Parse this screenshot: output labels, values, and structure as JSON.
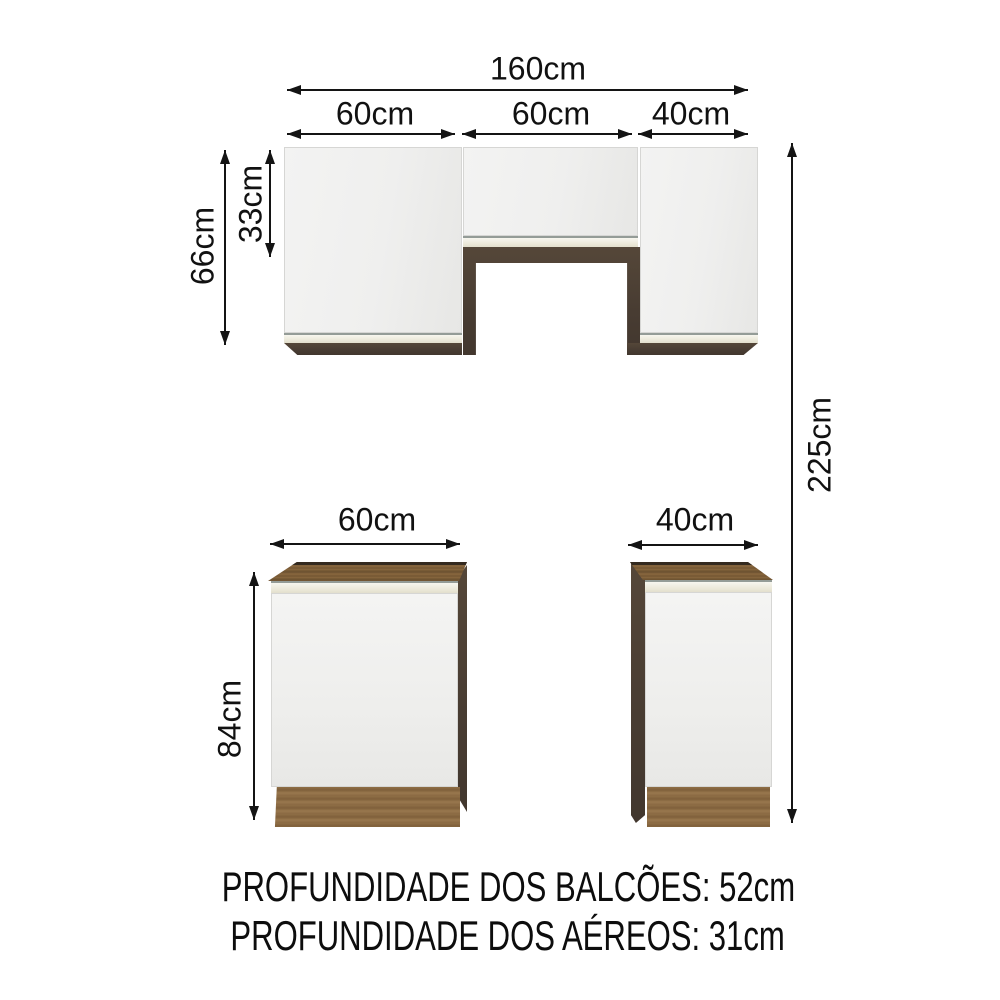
{
  "dimensions": {
    "total_width": "160cm",
    "upper_segments": {
      "left": "60cm",
      "middle": "60cm",
      "right": "40cm"
    },
    "upper_unit_height": "66cm",
    "upper_middle_door_height": "33cm",
    "total_height": "225cm",
    "base_left_width": "60cm",
    "base_right_width": "40cm",
    "base_height": "84cm"
  },
  "footer": {
    "line1": "PROFUNDIDADE DOS BALCÕES: 52cm",
    "line2": "PROFUNDIDADE DOS AÉREOS: 31cm"
  },
  "colors": {
    "door_white": "#efefee",
    "trim_cream": "#ebe8d9",
    "wood_dark": "#4a3e35",
    "wood_countertop": "#7b5c36",
    "wood_plinth": "#8d6c44",
    "line_black": "#141414"
  }
}
